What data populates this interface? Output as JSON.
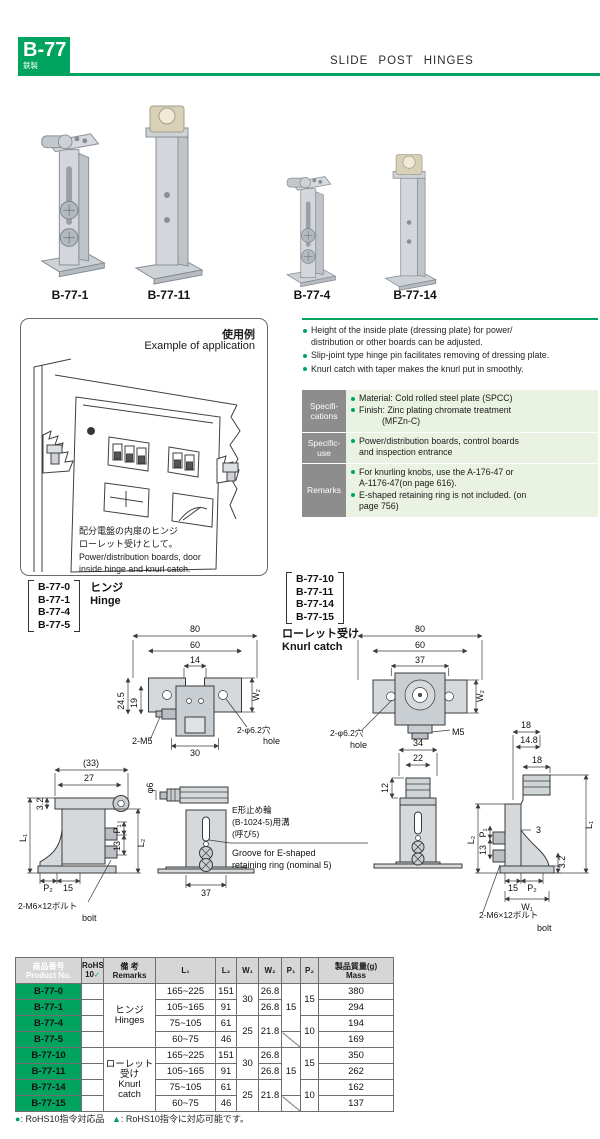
{
  "header": {
    "code": "B-77",
    "subtitle": "鉄製",
    "title": "SLIDE POST HINGES",
    "accent_color": "#00a45e"
  },
  "products": {
    "p1": "B-77-1",
    "p2": "B-77-11",
    "p3": "B-77-4",
    "p4": "B-77-14"
  },
  "application": {
    "title_ja": "使用例",
    "title_en": "Example of application",
    "cap1": "配分電盤の内扉のヒンジ",
    "cap2": "ローレット受けとして。",
    "cap3": "Power/distribution boards, door",
    "cap4": "inside hinge and knurl catch."
  },
  "features": {
    "f1a": "Height of the inside plate (dressing plate) for power/",
    "f1b": "distribution or other boards can be adjusted.",
    "f2": "Slip-joint type hinge pin facilitates removing of dressing plate.",
    "f3": "Knurl catch with taper makes the knurl put in smoothly."
  },
  "specs": {
    "r1l1": "Specifi-",
    "r1l2": "cations",
    "r1i1": "Material: Cold rolled steel plate (SPCC)",
    "r1i2": "Finish: Zinc plating chromate treatment",
    "r1i3": "(MFZn-C)",
    "r2l1": "Specific-",
    "r2l2": "use",
    "r2i1": "Power/distribution boards, control boards",
    "r2i2": "and inspection entrance",
    "r3l": "Remarks",
    "r3i1": "For knurling knobs, use the A-176-47 or",
    "r3i2": "A-1176-47(on page 616).",
    "r3i3": "E-shaped retaining ring is not included. (on",
    "r3i4": "page 756)"
  },
  "groups": {
    "hinge": {
      "m1": "B-77-0",
      "m2": "B-77-1",
      "m3": "B-77-4",
      "m4": "B-77-5",
      "ja": "ヒンジ",
      "en": "Hinge"
    },
    "knurl": {
      "m1": "B-77-10",
      "m2": "B-77-11",
      "m3": "B-77-14",
      "m4": "B-77-15",
      "ja": "ローレット受け",
      "en": "Knurl catch"
    }
  },
  "dims": {
    "d80": "80",
    "d60": "60",
    "d14": "14",
    "d24_5": "24.5",
    "d19": "19",
    "m5_2": "2-M5",
    "d30": "30",
    "hole_ja": "2-φ6.2穴",
    "hole_en": "hole",
    "w2": "W₂",
    "d37": "37",
    "m5": "M5",
    "d33p": "(33)",
    "d27": "27",
    "d3_2": "3.2",
    "l1": "L₁",
    "l2": "L₂",
    "p1": "P₁",
    "p2": "P₂",
    "d13": "13",
    "d15": "15",
    "bolt_ja": "2-M6×12ボルト",
    "bolt_en": "bolt",
    "phi6": "φ6",
    "eg_ja1": "E形止め輪",
    "eg_ja2": "(B-1024-5)用溝",
    "eg_ja3": "(呼び5)",
    "eg_en1": "Groove for E-shaped",
    "eg_en2": "retaining ring (nominal 5)",
    "d34": "34",
    "d22": "22",
    "d12": "12",
    "d18": "18",
    "d14_8": "14.8",
    "d3": "3",
    "w1": "W₁"
  },
  "table": {
    "h_product_ja": "商品番号",
    "h_product_en": "Product No.",
    "h_rohs": "RoHS",
    "h_rohs_num": "10",
    "rohs_check": "✓",
    "h_remarks_ja": "備 考",
    "h_remarks_en": "Remarks",
    "h_l1": "L₁",
    "h_l2": "L₂",
    "h_w1": "W₁",
    "h_w2": "W₂",
    "h_p1": "P₁",
    "h_p2": "P₂",
    "h_mass_ja": "製品質量(g)",
    "h_mass_en": "Mass",
    "group1_ja": "ヒンジ",
    "group1_en": "Hinges",
    "group2_ja": "ローレット",
    "group2_ja2": "受け",
    "group2_en": "Knurl",
    "group2_en2": "catch",
    "rows": [
      {
        "no": "B-77-0",
        "l1": "165~225",
        "l2": "151",
        "w1": "30",
        "w2": "26.8",
        "p1": "15",
        "p2": "15",
        "mass": "380"
      },
      {
        "no": "B-77-1",
        "l1": "105~165",
        "l2": "91",
        "w2": "26.8",
        "mass": "294"
      },
      {
        "no": "B-77-4",
        "l1": "75~105",
        "l2": "61",
        "w1": "25",
        "w2": "21.8",
        "p2": "10",
        "mass": "194"
      },
      {
        "no": "B-77-5",
        "l1": "60~75",
        "l2": "46",
        "mass": "169"
      },
      {
        "no": "B-77-10",
        "l1": "165~225",
        "l2": "151",
        "w1": "30",
        "w2": "26.8",
        "p1": "15",
        "p2": "15",
        "mass": "350"
      },
      {
        "no": "B-77-11",
        "l1": "105~165",
        "l2": "91",
        "w2": "26.8",
        "mass": "262"
      },
      {
        "no": "B-77-14",
        "l1": "75~105",
        "l2": "61",
        "w1": "25",
        "w2": "21.8",
        "p2": "10",
        "mass": "162"
      },
      {
        "no": "B-77-15",
        "l1": "60~75",
        "l2": "46",
        "mass": "137"
      }
    ]
  },
  "footnote": {
    "sym1": "●",
    "t1": ": RoHS10指令対応品",
    "sym2": "▲",
    "t2": ": RoHS10指令に対応可能です。"
  }
}
